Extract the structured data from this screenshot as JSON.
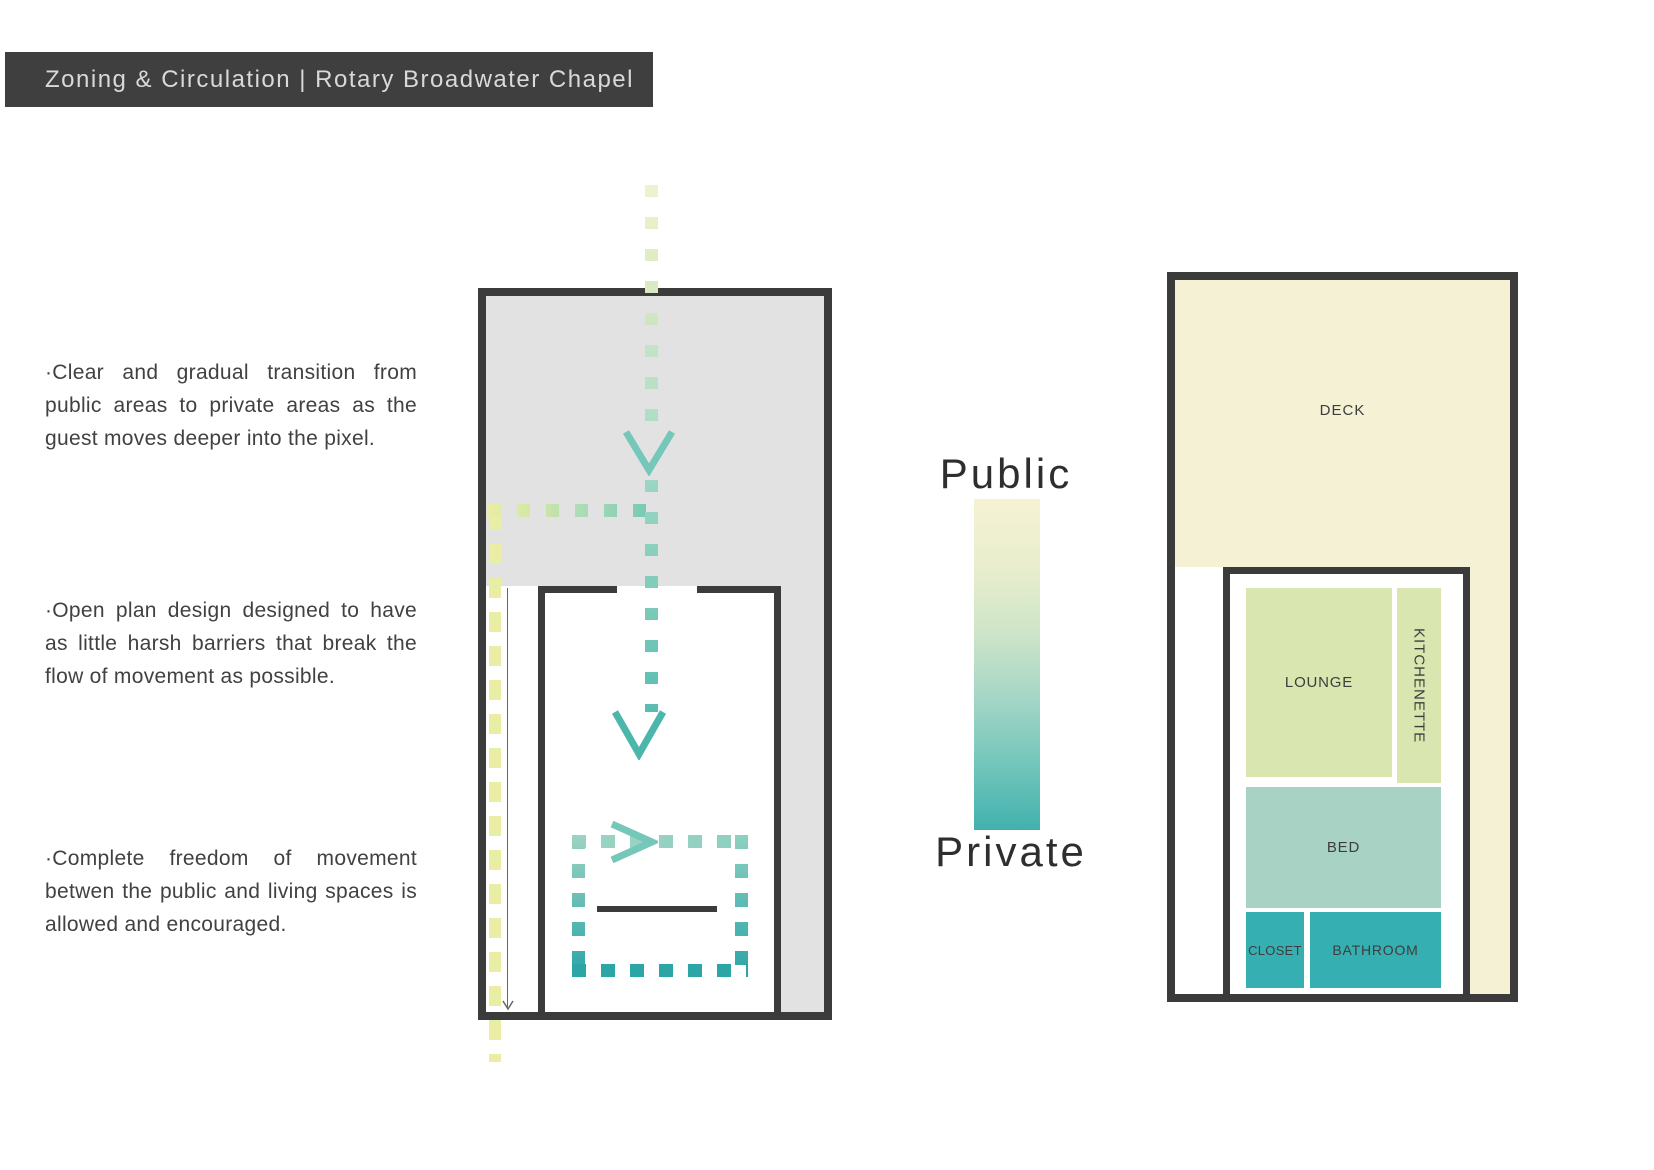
{
  "header": {
    "title": "Zoning & Circulation | Rotary Broadwater Chapel"
  },
  "notes": [
    "·Clear and gradual transition from public areas to private areas as the guest moves deeper into the pixel.",
    "·Open plan design designed to have as little harsh barriers that break the flow of movement as possible.",
    "·Complete freedom of movement betwen the public and living spaces is allowed and encouraged."
  ],
  "legend": {
    "public_label": "Public",
    "private_label": "Private"
  },
  "zoning_plan": {
    "deck_label": "DECK",
    "lounge_label": "LOUNGE",
    "kitchenette_label": "KITCHENETTE",
    "bed_label": "BED",
    "closet_label": "CLOSET",
    "bathroom_label": "BATHROOM"
  },
  "icons": {
    "flow_arrow_down": "arrow-down-chevron",
    "flow_arrow_right": "arrow-right-chevron",
    "guide_arrow_down": "thin-arrow-down"
  },
  "colors": {
    "header_bg": "#3f3f3f",
    "header_text": "#d9d9d9",
    "wall": "#3b3b3b",
    "text_dark": "#414141",
    "plan_gray": "#e2e2e2",
    "cream": "#f5f1d5",
    "room_green": "#d9e6b0",
    "room_seafoam": "#a8d3c4",
    "room_teal": "#36afb2",
    "path_yellow": "#eaeda4",
    "path_teal_light": "#9dd3c3",
    "path_teal_dark": "#2ba5a6",
    "arrow_light": "#74c7b9",
    "arrow_mid": "#4bb7ab",
    "gradient_top": "#f6f2d3",
    "gradient_bottom": "#42b1ae"
  }
}
